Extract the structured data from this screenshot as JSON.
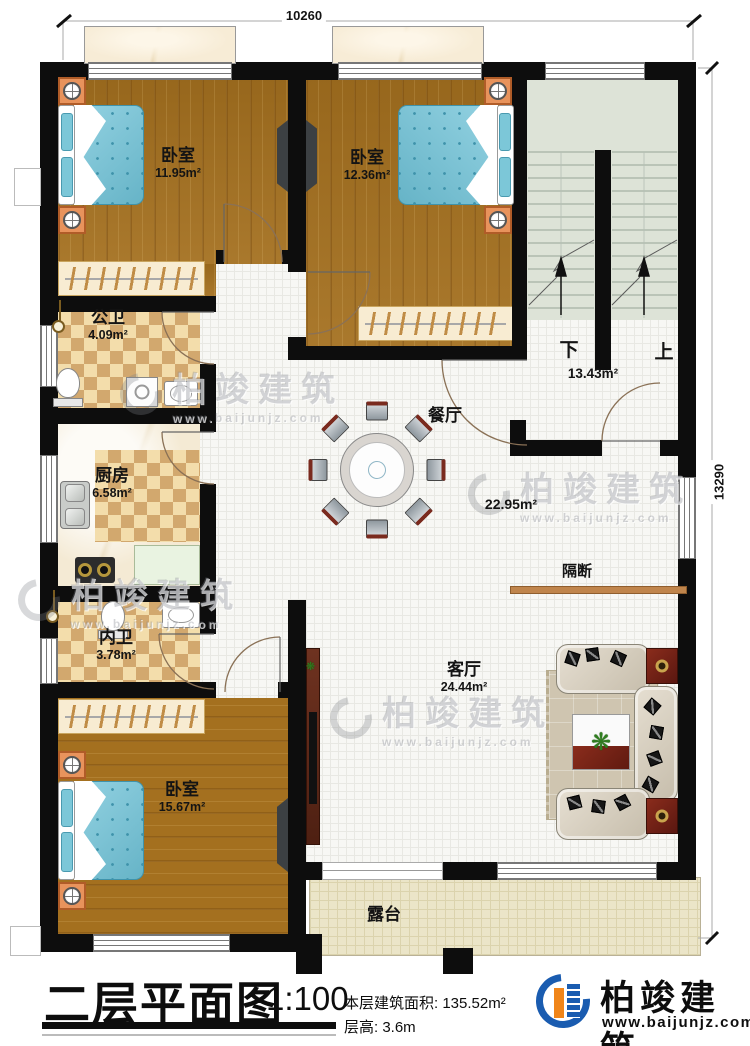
{
  "dimensions": {
    "top": "10260",
    "right": "13290"
  },
  "rooms": {
    "bedroom1": {
      "label": "卧室",
      "area": "11.95m²"
    },
    "bedroom2": {
      "label": "卧室",
      "area": "12.36m²"
    },
    "bedroom3": {
      "label": "卧室",
      "area": "15.67m²"
    },
    "public_bath": {
      "label": "公卫",
      "area": "4.09m²"
    },
    "kitchen": {
      "label": "厨房",
      "area": "6.58m²"
    },
    "inner_bath": {
      "label": "内卫",
      "area": "3.78m²"
    },
    "dining": {
      "label": "餐厅",
      "area": "22.95m²"
    },
    "living": {
      "label": "客厅",
      "area": "24.44m²"
    },
    "stair_hall": {
      "area": "13.43m²"
    },
    "terrace": {
      "label": "露台"
    }
  },
  "annotations": {
    "partition": "隔断",
    "stair_down": "下",
    "stair_up": "上"
  },
  "title_block": {
    "title": "二层平面图",
    "scale": "1:100",
    "floor_area": "本层建筑面积: 135.52m²",
    "floor_height": "层高: 3.6m",
    "brand": "柏竣建筑",
    "website": "www.baijunjz.com"
  },
  "watermark": {
    "brand": "柏竣建筑",
    "website": "www.baijunjz.com"
  }
}
